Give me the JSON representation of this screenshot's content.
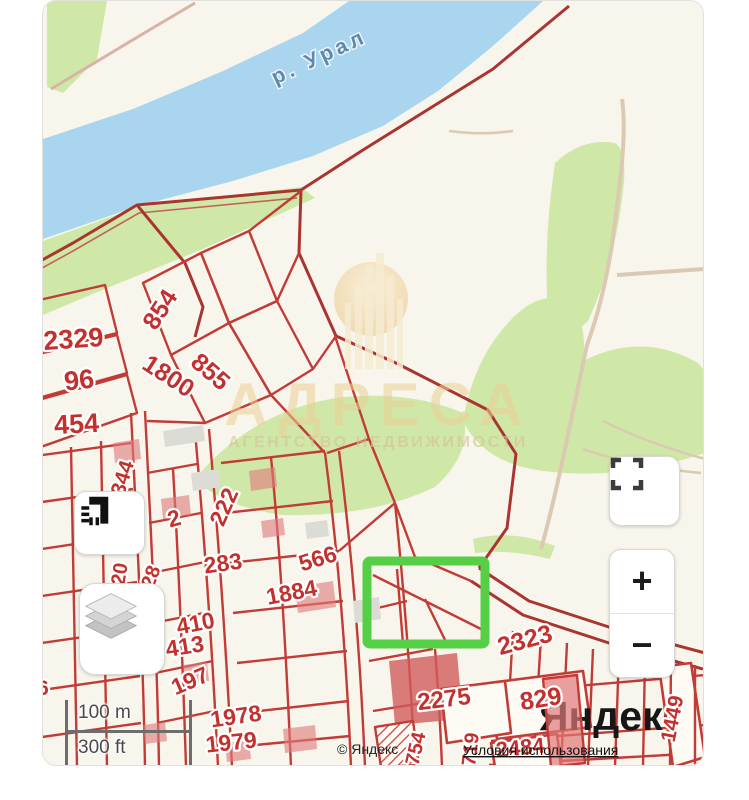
{
  "map": {
    "river_label": "р. Урал",
    "watermark": {
      "title": "АДРЕСА",
      "subtitle": "АГЕНТСТВО НЕДВИЖИМОСТИ"
    },
    "labels": [
      {
        "text": "2329"
      },
      {
        "text": "96"
      },
      {
        "text": "454"
      },
      {
        "text": "854"
      },
      {
        "text": "1800"
      },
      {
        "text": "855"
      },
      {
        "text": "344"
      },
      {
        "text": "2"
      },
      {
        "text": "222"
      },
      {
        "text": "283"
      },
      {
        "text": "566"
      },
      {
        "text": "1884"
      },
      {
        "text": "20"
      },
      {
        "text": "28"
      },
      {
        "text": "410"
      },
      {
        "text": "413"
      },
      {
        "text": "197"
      },
      {
        "text": "1978"
      },
      {
        "text": "1979"
      },
      {
        "text": "2323"
      },
      {
        "text": "829"
      },
      {
        "text": "2275"
      },
      {
        "text": "1449"
      },
      {
        "text": "2484"
      },
      {
        "text": "719"
      },
      {
        "text": "754"
      },
      {
        "text": "6"
      }
    ],
    "yandex_logo": "Яндекс",
    "attribution": {
      "copyright": "© Яндекс",
      "terms": "Условия использования"
    },
    "highlight_color": "#55cf45"
  },
  "controls": {
    "zoom_in": "+",
    "zoom_out": "−"
  },
  "scale_bar": {
    "metric": "100 m",
    "imperial": "300 ft"
  },
  "colors": {
    "parcel_line": "#c23b36",
    "boundary_dark": "#a93530",
    "river": "#a9d6ee",
    "vegetation": "#cfe8a8",
    "background": "#f8f5ec",
    "watermark_gold": "#eccf96",
    "highlight_green": "#55cf45"
  }
}
